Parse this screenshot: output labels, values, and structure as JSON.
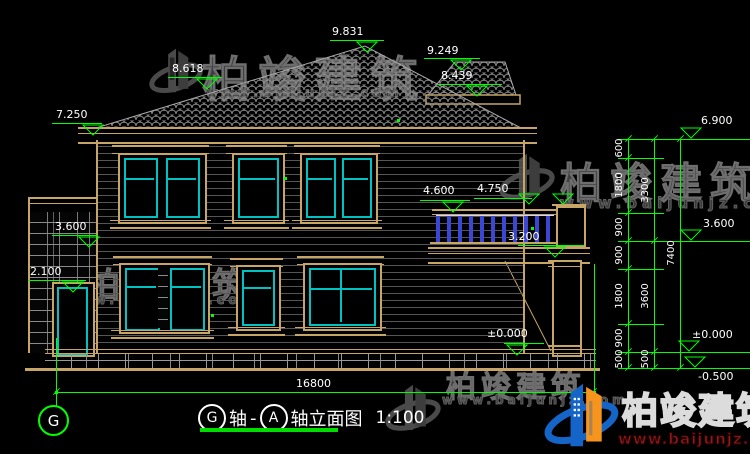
{
  "title_block": {
    "axis_start": "G",
    "mid_text": "轴",
    "dash": "-",
    "axis_end": "A",
    "suffix_text": "轴立面图",
    "scale": "1:100"
  },
  "axis_bubbles": {
    "left": "G"
  },
  "dimensions": {
    "overall_width": "16800",
    "right_chain_inner": [
      "600",
      "1800",
      "900",
      "900",
      "1800",
      "900",
      "500"
    ],
    "right_chain_middle": [
      "3300",
      "3600",
      "500"
    ],
    "right_chain_outer": [
      "7400"
    ]
  },
  "levels": {
    "ridge_main": "9.831",
    "ridge_secondary": "9.249",
    "roof_left": "8.618",
    "eave_secondary": "8.439",
    "eave_left": "7.250",
    "porch_roof": "3.600",
    "door_head": "2.100",
    "balcony_rail": "4.600",
    "balcony_pillar": "4.750",
    "balcony_floor": "3.200",
    "ground_main": "±0.000",
    "right_levels": [
      "6.900",
      "3.600",
      "±0.000",
      "-0.500"
    ]
  },
  "watermarks": {
    "brand": "柏竣建筑",
    "site": "www.baijunjz.com"
  },
  "logo": {
    "brand": "柏竣建筑",
    "site": "www.baijunjz.com",
    "brand_color": "#1565c8",
    "accent_color": "#f7941d",
    "site_color": "#8b1a1a"
  },
  "colors": {
    "background": "#000000",
    "linework_tan": "#c6a566",
    "window_cyan": "#00c2c2",
    "dimension_green": "#00ff00",
    "baluster_blue": "#3a46d4",
    "watermark_gray": "#4a4a4a",
    "text_white": "#ffffff"
  }
}
